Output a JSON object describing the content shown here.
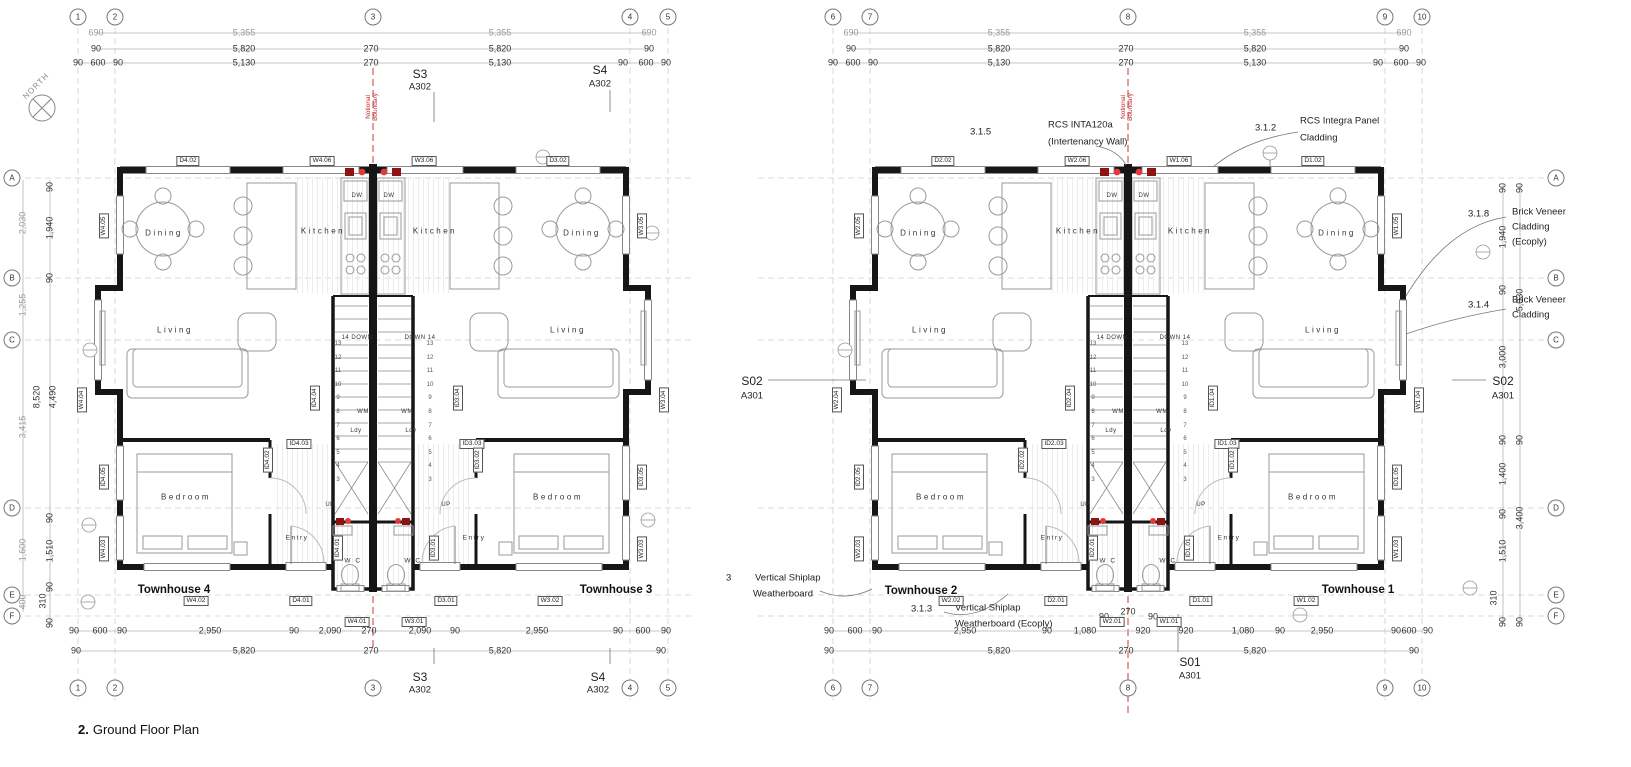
{
  "sheet": {
    "title_number": "2.",
    "title_text": "Ground Floor Plan"
  },
  "compass": {
    "north": "NORTH"
  },
  "boundary": {
    "line1": "Notional",
    "line2": "Boundary"
  },
  "grid": {
    "cols": [
      "1",
      "2",
      "3",
      "4",
      "5",
      "6",
      "7",
      "8",
      "9",
      "10"
    ],
    "rows": [
      "A",
      "B",
      "C",
      "D",
      "E",
      "F"
    ]
  },
  "sections": {
    "s3_name": "S3",
    "s3_sheet": "A302",
    "s4_name": "S4",
    "s4_sheet": "A302",
    "s01_name": "S01",
    "s01_sheet": "A301",
    "s02_name": "S02",
    "s02_sheet": "A301"
  },
  "units": {
    "th1": "Townhouse 1",
    "th2": "Townhouse 2",
    "th3": "Townhouse 3",
    "th4": "Townhouse 4"
  },
  "rooms": {
    "dining": "Dining",
    "kitchen": "Kitchen",
    "living": "Living",
    "bedroom": "Bedroom",
    "entry": "Entry",
    "wc": "W C",
    "ldy": "Ldy",
    "wm": "WM",
    "dw": "DW",
    "down_l": "14 DOWN",
    "down_r": "DOWN 14",
    "up": "UP"
  },
  "stairs": {
    "numbers": [
      "13",
      "12",
      "11",
      "10",
      "9",
      "8",
      "7",
      "6",
      "5",
      "4",
      "3"
    ]
  },
  "annotations": {
    "a315_ref": "3.1.5",
    "a315_l1": "RCS INTA120a",
    "a315_l2": "(Intertenancy Wall)",
    "a312_ref": "3.1.2",
    "a312_l1": "RCS Integra Panel",
    "a312_l2": "Cladding",
    "a318_ref": "3.1.8",
    "a318_l1": "Brick Veneer",
    "a318_l2": "Cladding",
    "a318_l3": "(Ecoply)",
    "a314_ref": "3.1.4",
    "a314_l1": "Brick Veneer",
    "a314_l2": "Cladding",
    "a3_ref": "3",
    "a3_l1": "Vertical Shiplap",
    "a3_l2": "Weatherboard",
    "a313_ref": "3.1.3",
    "a313_l1": "Vertical Shiplap",
    "a313_l2": "Weatherboard (Ecoply)"
  },
  "dims": {
    "top0": [
      "690",
      "5,355",
      "5,355",
      "690"
    ],
    "top1": [
      "90",
      "5,820",
      "270",
      "5,820",
      "90"
    ],
    "top2": [
      "90",
      "600",
      "90",
      "5,130",
      "270",
      "5,130",
      "90",
      "600",
      "90"
    ],
    "botL1": [
      "90",
      "600",
      "90",
      "2,950",
      "90",
      "2,090",
      "270",
      "2,090",
      "90",
      "2,950",
      "90",
      "600",
      "90"
    ],
    "bot2": [
      "90",
      "5,820",
      "270",
      "5,820",
      "90"
    ],
    "botR1": [
      "90",
      "600",
      "90",
      "2,950",
      "90",
      "1,080",
      "920",
      "920",
      "1,080",
      "90",
      "2,950",
      "90",
      "600",
      "90"
    ],
    "botR_raised": [
      "90",
      "270",
      "90"
    ],
    "leftOuter": [
      "2,030",
      "1,255",
      "3,415",
      "1,600",
      "400"
    ],
    "leftSpan": "8,520",
    "leftInner": [
      "90",
      "1,940",
      "90",
      "4,490",
      "90",
      "1,510",
      "90",
      "310",
      "90"
    ],
    "rightInner": [
      "90",
      "1,940",
      "90",
      "3,000",
      "90",
      "1,400",
      "90",
      "1,510",
      "310",
      "90"
    ],
    "rightOuter": [
      "90",
      "5,030",
      "90",
      "3,400",
      "90"
    ]
  },
  "tags": {
    "topL": [
      "D4.02",
      "W4.06",
      "W3.06",
      "D3.02"
    ],
    "topR": [
      "D2.02",
      "W2.06",
      "W1.06",
      "D1.02"
    ],
    "wallL_l": [
      "W4.05",
      "W4.04",
      "ID4.05",
      "W4.03"
    ],
    "wallL_r": [
      "W3.05",
      "W3.04",
      "ID3.05",
      "W3.03"
    ],
    "wallR_l": [
      "W2.05",
      "W2.04",
      "ID2.05",
      "W2.03"
    ],
    "wallR_r": [
      "W1.05",
      "W1.04",
      "ID1.05",
      "W1.03"
    ],
    "botL": [
      "W4.02",
      "D4.01",
      "W4.01",
      "W3.01",
      "D3.01",
      "W3.02"
    ],
    "botR": [
      "W2.02",
      "D2.01",
      "W2.01",
      "W1.01",
      "D1.01",
      "W1.02"
    ],
    "coreL": [
      "ID4.04",
      "ID3.04",
      "ID4.03",
      "ID3.03",
      "ID4.02",
      "ID3.02",
      "ID4.01",
      "ID3.01"
    ],
    "coreR": [
      "ID2.04",
      "ID1.04",
      "ID2.03",
      "ID1.03",
      "ID2.02",
      "ID1.02",
      "ID2.01",
      "ID1.01"
    ]
  }
}
